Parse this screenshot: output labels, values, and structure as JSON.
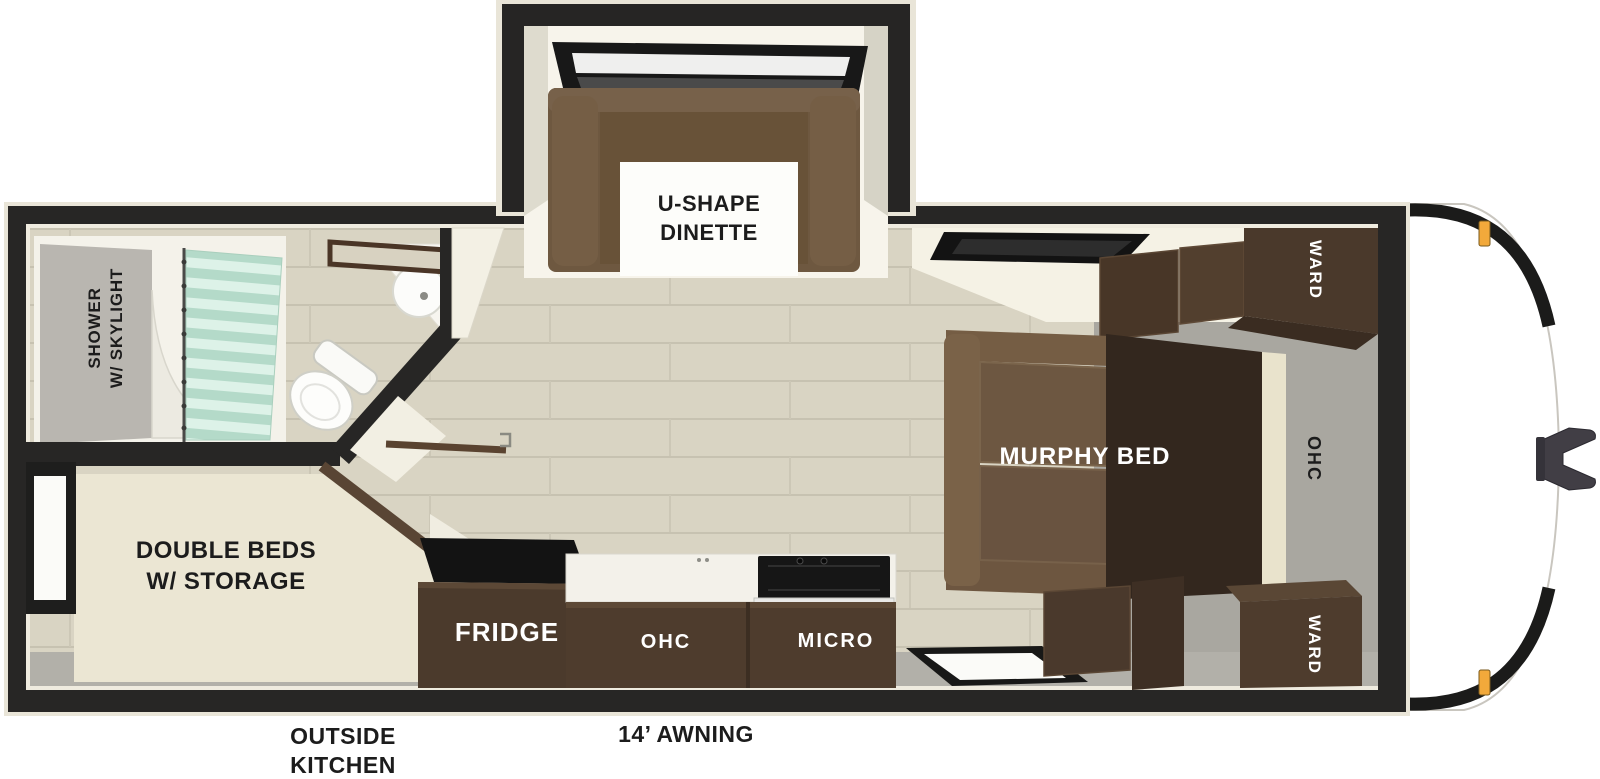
{
  "diagram": {
    "type": "rv-floorplan",
    "palette": {
      "wall_black": "#272625",
      "trim_cream": "#e9e5d8",
      "interior_white": "#f6f3ea",
      "floor_plank": "#d9d4c3",
      "plank_line": "#c7c2b1",
      "carpet_gray": "#a9a7a0",
      "sofa_brown": "#6e5840",
      "cabinet_brown": "#4b3a2c",
      "platform_dark": "#33271e",
      "mattress_cream": "#ebe6d3",
      "curtain_mint": "#c3e2d2",
      "appliance_black": "#161616",
      "marker_orange": "#f2a93b",
      "label_dark": "#1c1c1c",
      "label_light": "#ffffff"
    },
    "rooms": {
      "dinette": {
        "label": "U-SHAPE\nDINETTE"
      },
      "bathroom": {
        "shower_label": "SHOWER\nW/ SKYLIGHT"
      },
      "bedroom": {
        "label": "DOUBLE BEDS\nW/ STORAGE"
      },
      "kitchen": {
        "fridge_label": "FRIDGE",
        "ohc_label": "OHC",
        "micro_label": "MICRO"
      },
      "front_bedroom": {
        "murphy_label": "MURPHY BED",
        "ward_top_label": "WARD",
        "ward_bottom_label": "WARD",
        "ohc_label": "OHC"
      }
    },
    "exterior": {
      "outside_kitchen_label": "OUTSIDE\nKITCHEN",
      "awning_label": "14’ AWNING"
    }
  }
}
